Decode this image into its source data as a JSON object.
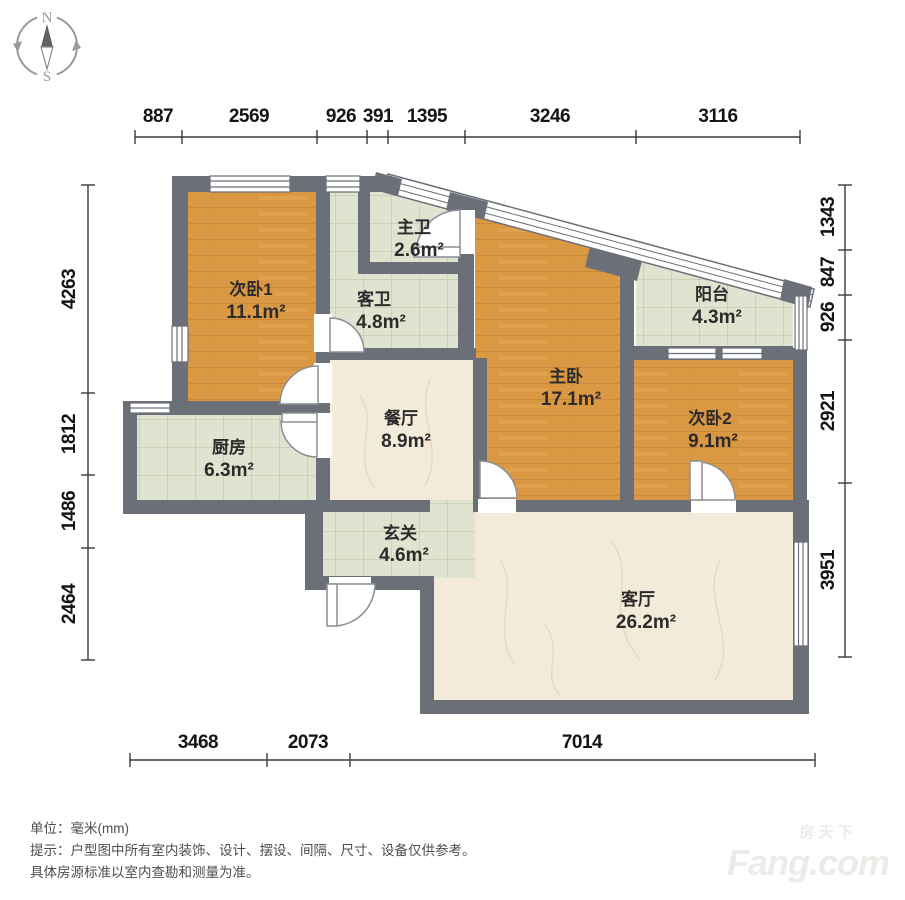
{
  "compass": {
    "n": "N",
    "s": "S"
  },
  "dims": {
    "top": [
      "887",
      "2569",
      "926",
      "391",
      "1395",
      "3246",
      "3116"
    ],
    "left": [
      "4263",
      "1812",
      "1486",
      "2464"
    ],
    "right": [
      "1343",
      "847",
      "926",
      "2921",
      "3951"
    ],
    "bottom": [
      "3468",
      "2073",
      "7014"
    ]
  },
  "rooms": {
    "ciwo1": {
      "name": "次卧1",
      "area": "11.1m²"
    },
    "zhuwei": {
      "name": "主卫",
      "area": "2.6m²"
    },
    "kewei": {
      "name": "客卫",
      "area": "4.8m²"
    },
    "zhuwo": {
      "name": "主卧",
      "area": "17.1m²"
    },
    "yangtai": {
      "name": "阳台",
      "area": "4.3m²"
    },
    "ciwo2": {
      "name": "次卧2",
      "area": "9.1m²"
    },
    "chufang": {
      "name": "厨房",
      "area": "6.3m²"
    },
    "canting": {
      "name": "餐厅",
      "area": "8.9m²"
    },
    "xuanguan": {
      "name": "玄关",
      "area": "4.6m²"
    },
    "keting": {
      "name": "客厅",
      "area": "26.2m²"
    }
  },
  "footer": {
    "unit": "单位：毫米(mm)",
    "tip1": "提示：户型图中所有室内装饰、设计、摆设、间隔、尺寸、设备仅供参考。",
    "tip2": "具体房源标准以室内查勘和测量为准。"
  },
  "watermark": {
    "cn": "房天下",
    "en": "Fang.com"
  },
  "colors": {
    "wall": "#6b6f77",
    "wood": "#db9843",
    "tile": "#e0e3cf",
    "marble": "#f3ead9"
  }
}
